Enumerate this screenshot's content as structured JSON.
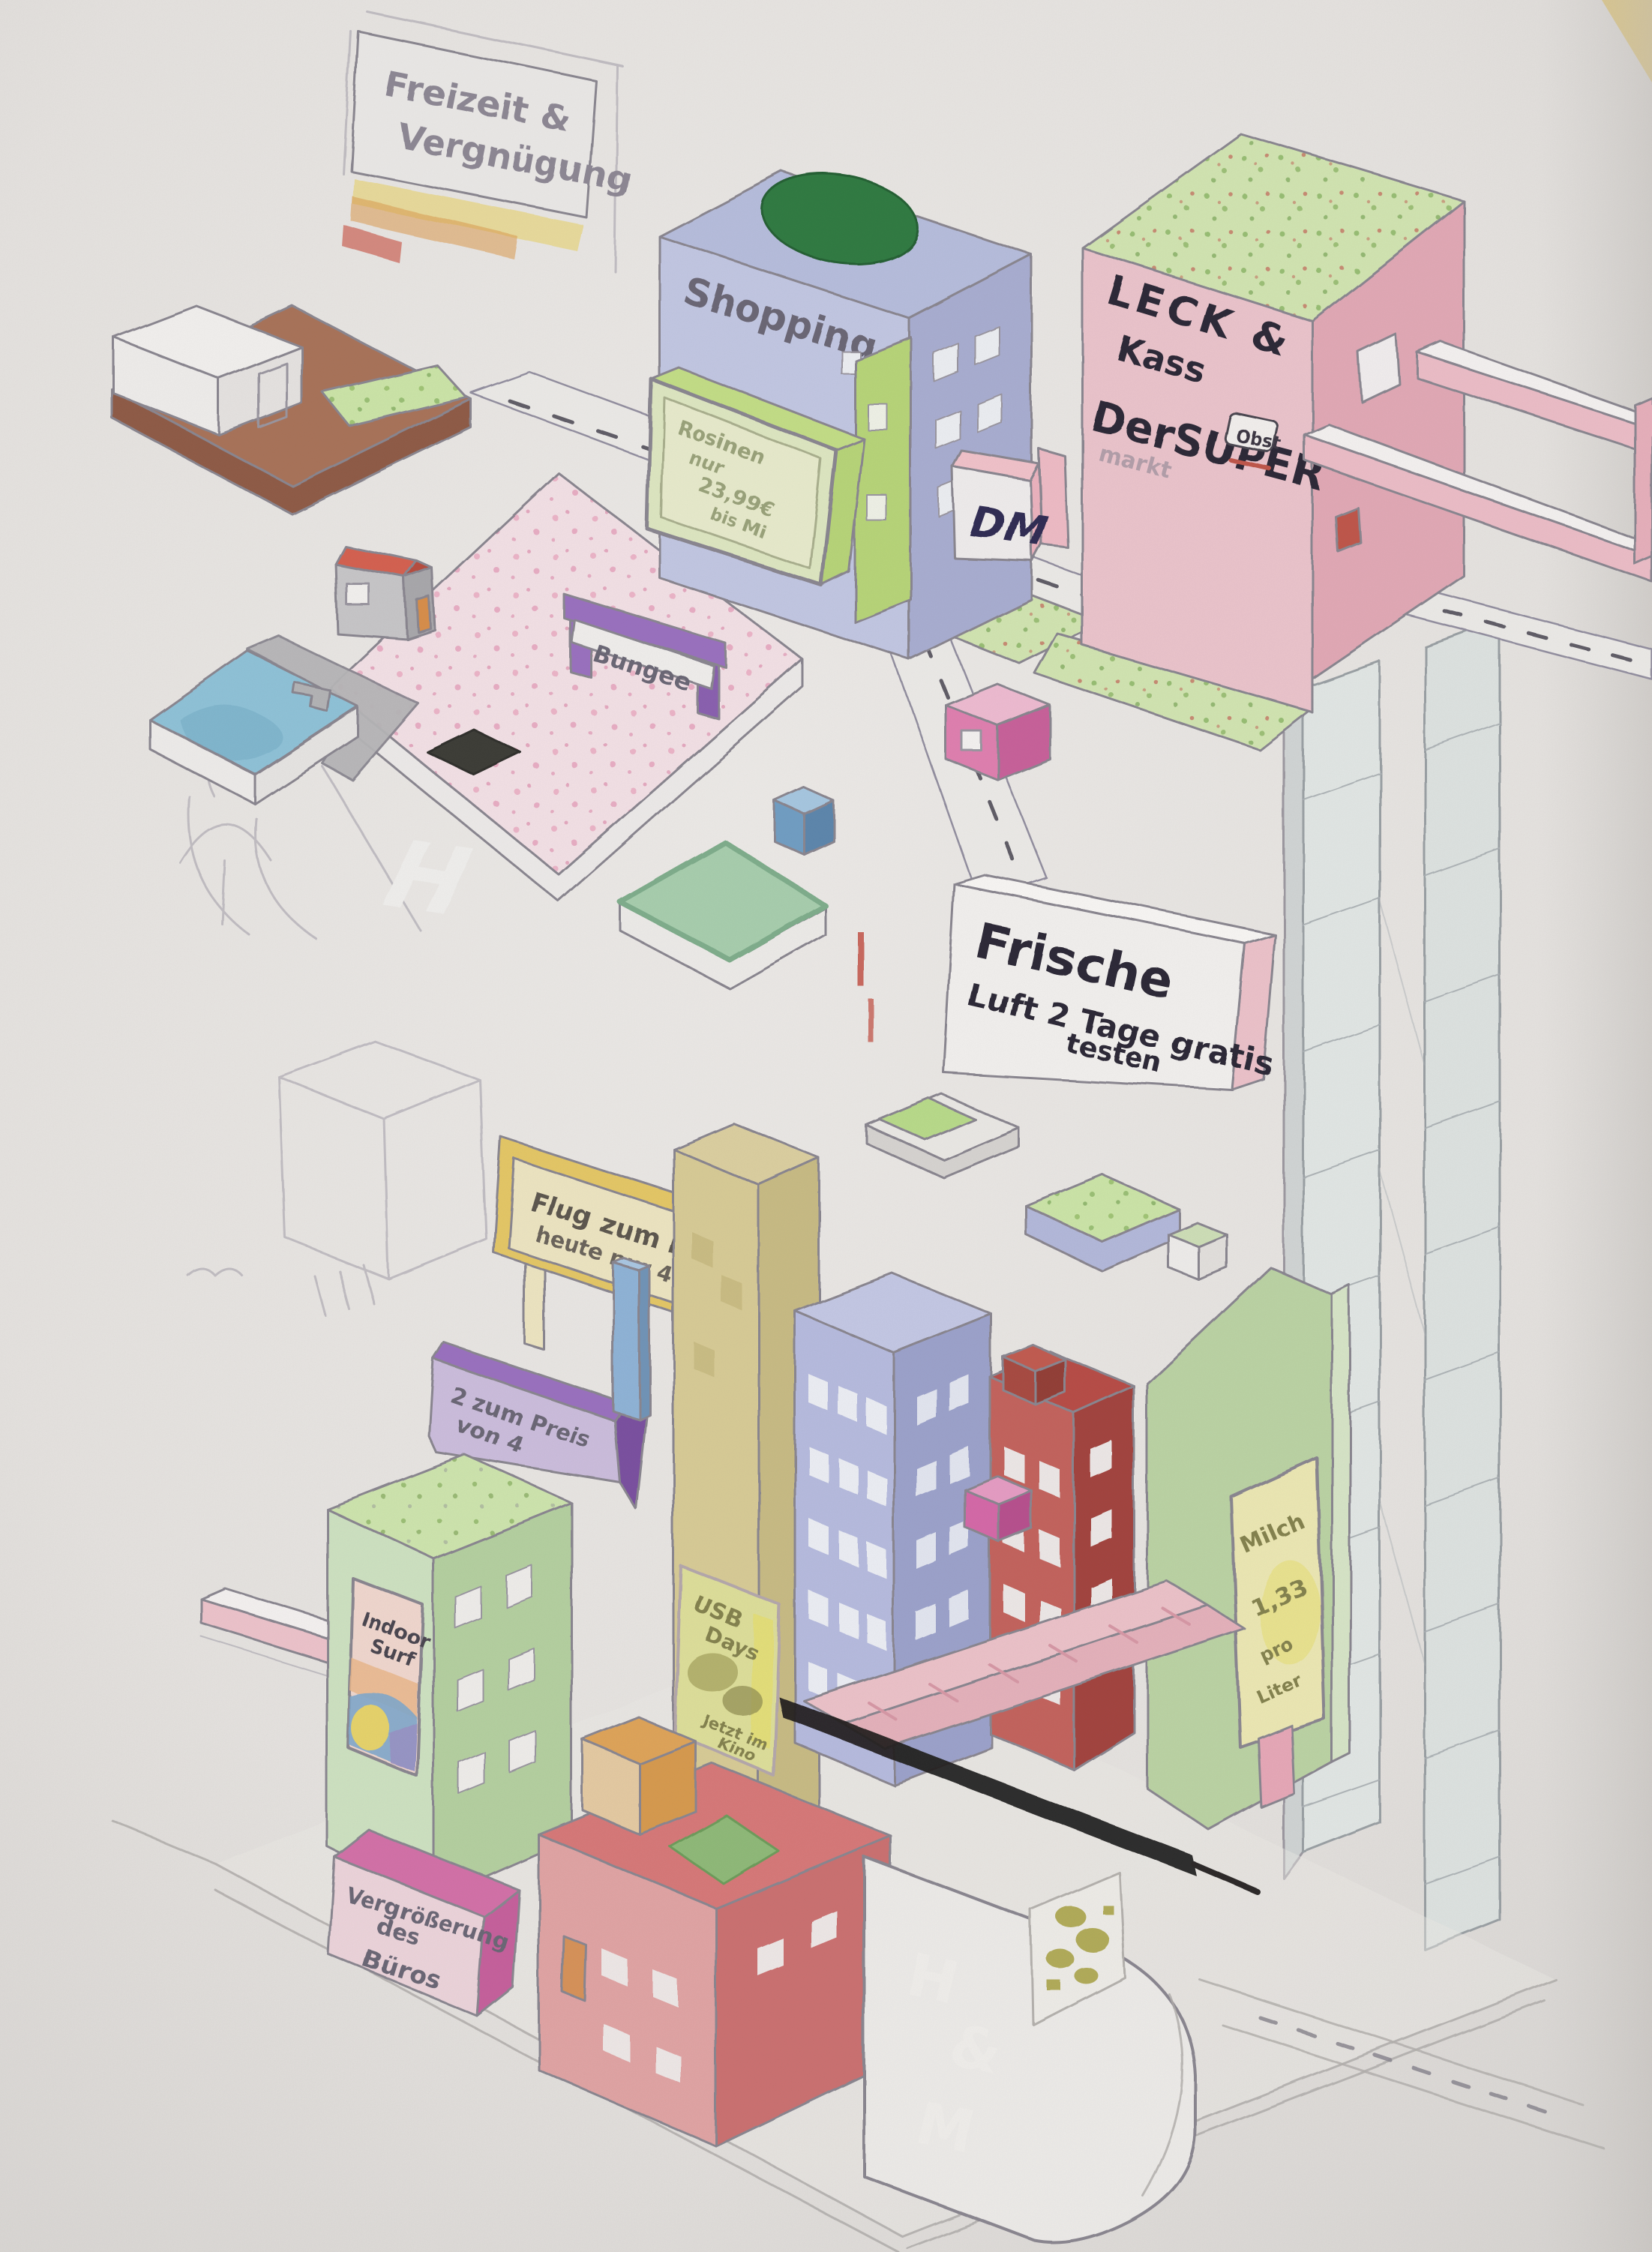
{
  "title_sign": {
    "line1": "Freizeit &",
    "line2": "Vergnügung"
  },
  "upper_level": {
    "shopping_label": "Shopping",
    "billboard": {
      "line1": "Rosinen",
      "line2": "nur",
      "line3": "23,99€",
      "line4": "bis Mi"
    },
    "dm_label": "DM",
    "supermarket": {
      "line1": "LECK &",
      "line2": "Kass",
      "line3": "DerSUPER",
      "line4": "markt",
      "badge": "Obst"
    },
    "bungee_label": "Bungee",
    "helipad_letter": "H",
    "fresh_air_sign": {
      "line1": "Frische",
      "line2": "Luft 2 Tage gratis",
      "line3": "testen"
    }
  },
  "lower_level": {
    "mars_sign": {
      "line1": "Flug zum Mars",
      "line2": "heute nur 48,80€"
    },
    "offer_sign": {
      "line1": "2 zum Preis",
      "line2": "von 4"
    },
    "surf_poster": {
      "line1": "Indoor",
      "line2": "Surf"
    },
    "usb_poster": {
      "line1": "USB",
      "line2": "Days",
      "line3": "Jetzt im",
      "line4": "Kino"
    },
    "milk_poster": {
      "line1": "Milch",
      "line2": "1,33",
      "line3": "pro",
      "line4": "Liter"
    },
    "office_sign": {
      "line1": "Vergrößerung",
      "line2": "des",
      "line3": "Büros"
    },
    "hm_letters": {
      "l1": "H",
      "l2": "&",
      "l3": "M"
    }
  },
  "colors": {
    "paper": "#eae7e4",
    "pencil": "#8a8690",
    "ink": "#2c2834",
    "pink_building": "#edc5cd",
    "pink_dark": "#e3a9b6",
    "periwinkle": "#c3c8e4",
    "periwinkle_dark": "#a9aed2",
    "lime_billboard": "#b8d678",
    "market_roof": "#d3e6b2",
    "purple": "#9a6fc0",
    "pool_blue": "#8fc3d9",
    "plaza_pink": "#f6e3e8",
    "helipad_green": "#a8cfae",
    "brown_platform": "#a97258",
    "yellow_sign": "#e6c865",
    "tan_building": "#d9cc96",
    "glass_blue": "#b7bce0",
    "brick_red": "#c4625c",
    "magenta": "#d667a8",
    "green_building": "#b5d1a0",
    "milk_green": "#bcd4a4",
    "red_roof_building": "#e2a4a4",
    "orange_cube": "#e0a458",
    "office_pink": "#eed5dc",
    "shadow_black": "#1d1b1a"
  }
}
